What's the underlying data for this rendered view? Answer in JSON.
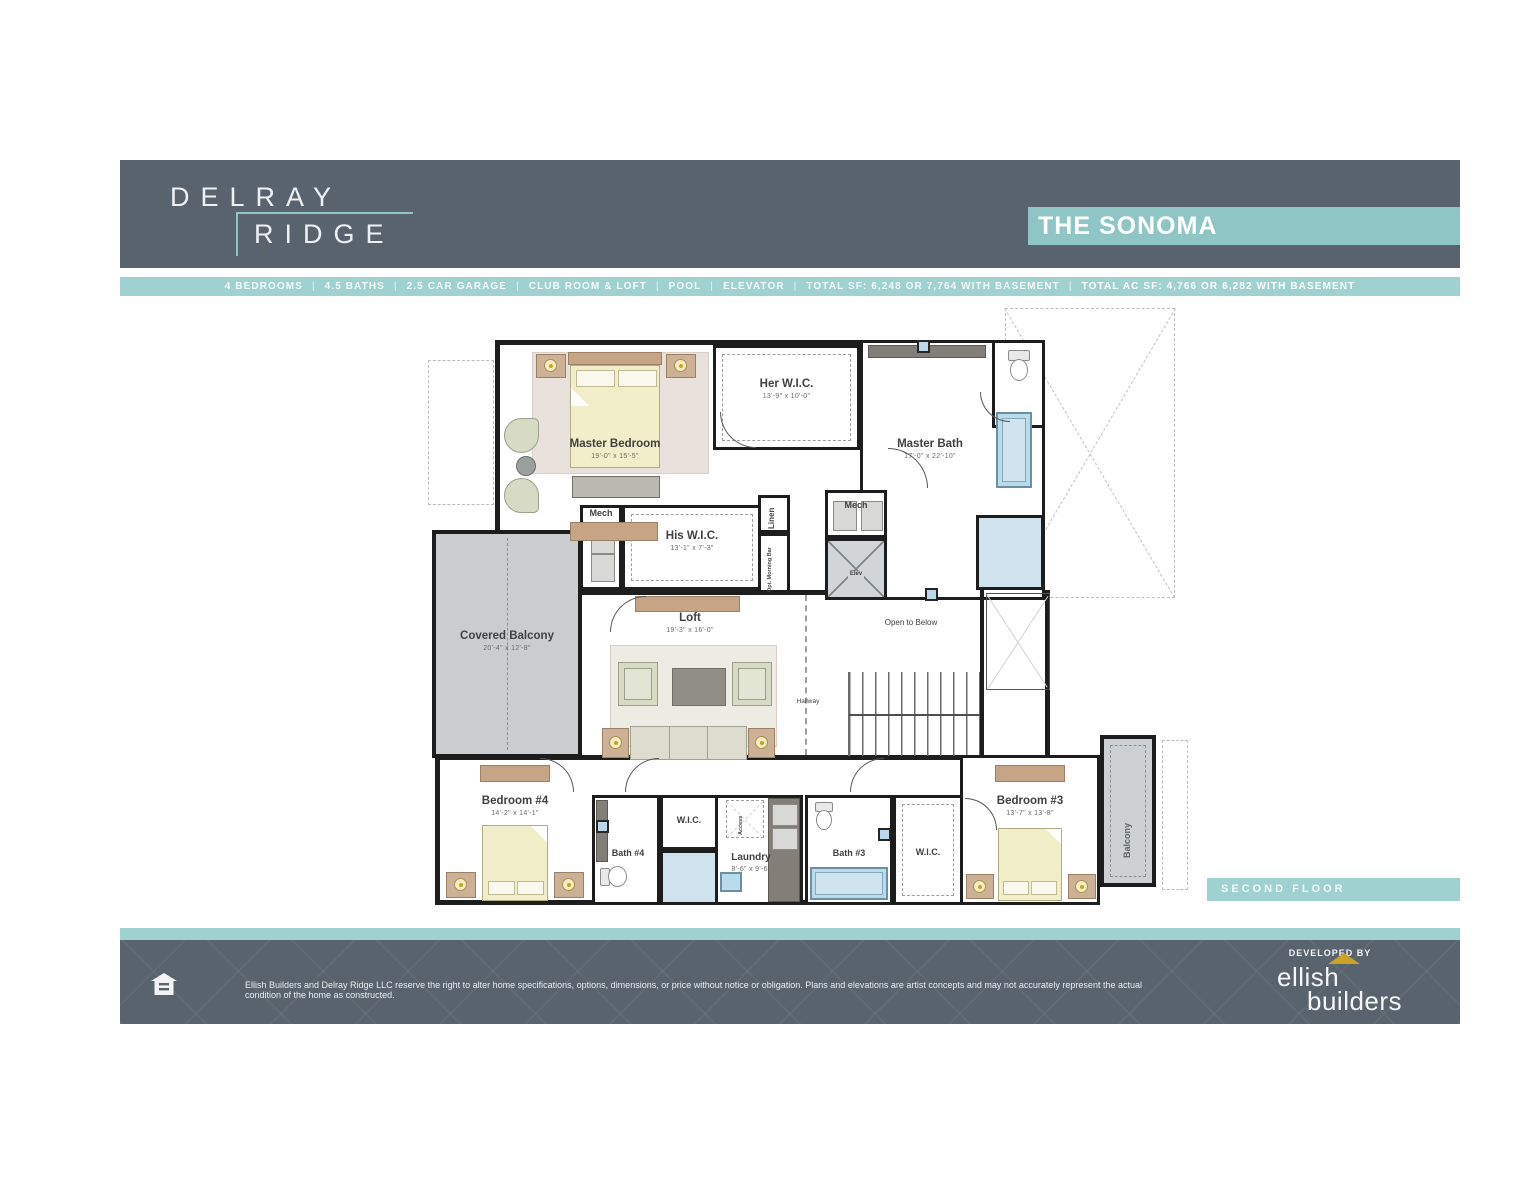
{
  "header": {
    "brand_top": "DELRAY",
    "brand_bottom": "RIDGE",
    "plan_name": "THE SONOMA"
  },
  "spec_bar": {
    "separator": "|",
    "items": [
      "4 BEDROOMS",
      "4.5 BATHS",
      "2.5 CAR GARAGE",
      "CLUB ROOM & LOFT",
      "POOL",
      "ELEVATOR",
      "TOTAL SF: 6,248 OR 7,764 WITH BASEMENT"
    ],
    "highlight": "TOTAL AC SF: 4,766 OR 6,282 WITH BASEMENT"
  },
  "floor_badge": "SECOND FLOOR",
  "rooms": {
    "master_bedroom": {
      "name": "Master Bedroom",
      "dims": "19'-0\" x 15'-5\""
    },
    "her_wic": {
      "name": "Her W.I.C.",
      "dims": "13'-9\" x 10'-0\""
    },
    "master_bath": {
      "name": "Master Bath",
      "dims": "17'-0\" x 22'-10\""
    },
    "mech_left": {
      "name": "Mech"
    },
    "his_wic": {
      "name": "His W.I.C.",
      "dims": "13'-1\" x 7'-3\""
    },
    "linen": {
      "name": "Linen"
    },
    "opt_morning_bar": {
      "name": "Opt. Morning Bar"
    },
    "mech_right": {
      "name": "Mech"
    },
    "elevator": {
      "name": "Elev"
    },
    "covered_balcony": {
      "name": "Covered Balcony",
      "dims": "20'-4\" x 12'-8\""
    },
    "loft": {
      "name": "Loft",
      "dims": "19'-3\" x 16'-0\""
    },
    "hallway": {
      "name": "Hallway"
    },
    "open_to_below": {
      "name": "Open to Below"
    },
    "bedroom4": {
      "name": "Bedroom #4",
      "dims": "14'-2\" x 14'-1\""
    },
    "bath4": {
      "name": "Bath #4"
    },
    "wic4": {
      "name": "W.I.C."
    },
    "laundry": {
      "name": "Laundry",
      "dims": "8'-6\" x 9'-6\""
    },
    "access": {
      "name": "Access"
    },
    "bath3": {
      "name": "Bath #3"
    },
    "wic3": {
      "name": "W.I.C."
    },
    "bedroom3": {
      "name": "Bedroom #3",
      "dims": "13'-7\" x 13'-8\""
    },
    "balcony": {
      "name": "Balcony"
    }
  },
  "footer": {
    "disclaimer": "Ellish Builders and Delray Ridge LLC reserve the right to alter home specifications, options, dimensions, or price without notice or obligation. Plans and elevations are artist concepts and may not accurately represent the actual condition of the home as constructed.",
    "developed_by": "DEVELOPED BY",
    "logo_top": "ellish",
    "logo_bottom": "builders"
  },
  "colors": {
    "slate": "#59636d",
    "teal": "#8fc5c4",
    "teal_light": "#9fd1d0",
    "wall": "#1d1d1d",
    "gold": "#c9a227"
  }
}
